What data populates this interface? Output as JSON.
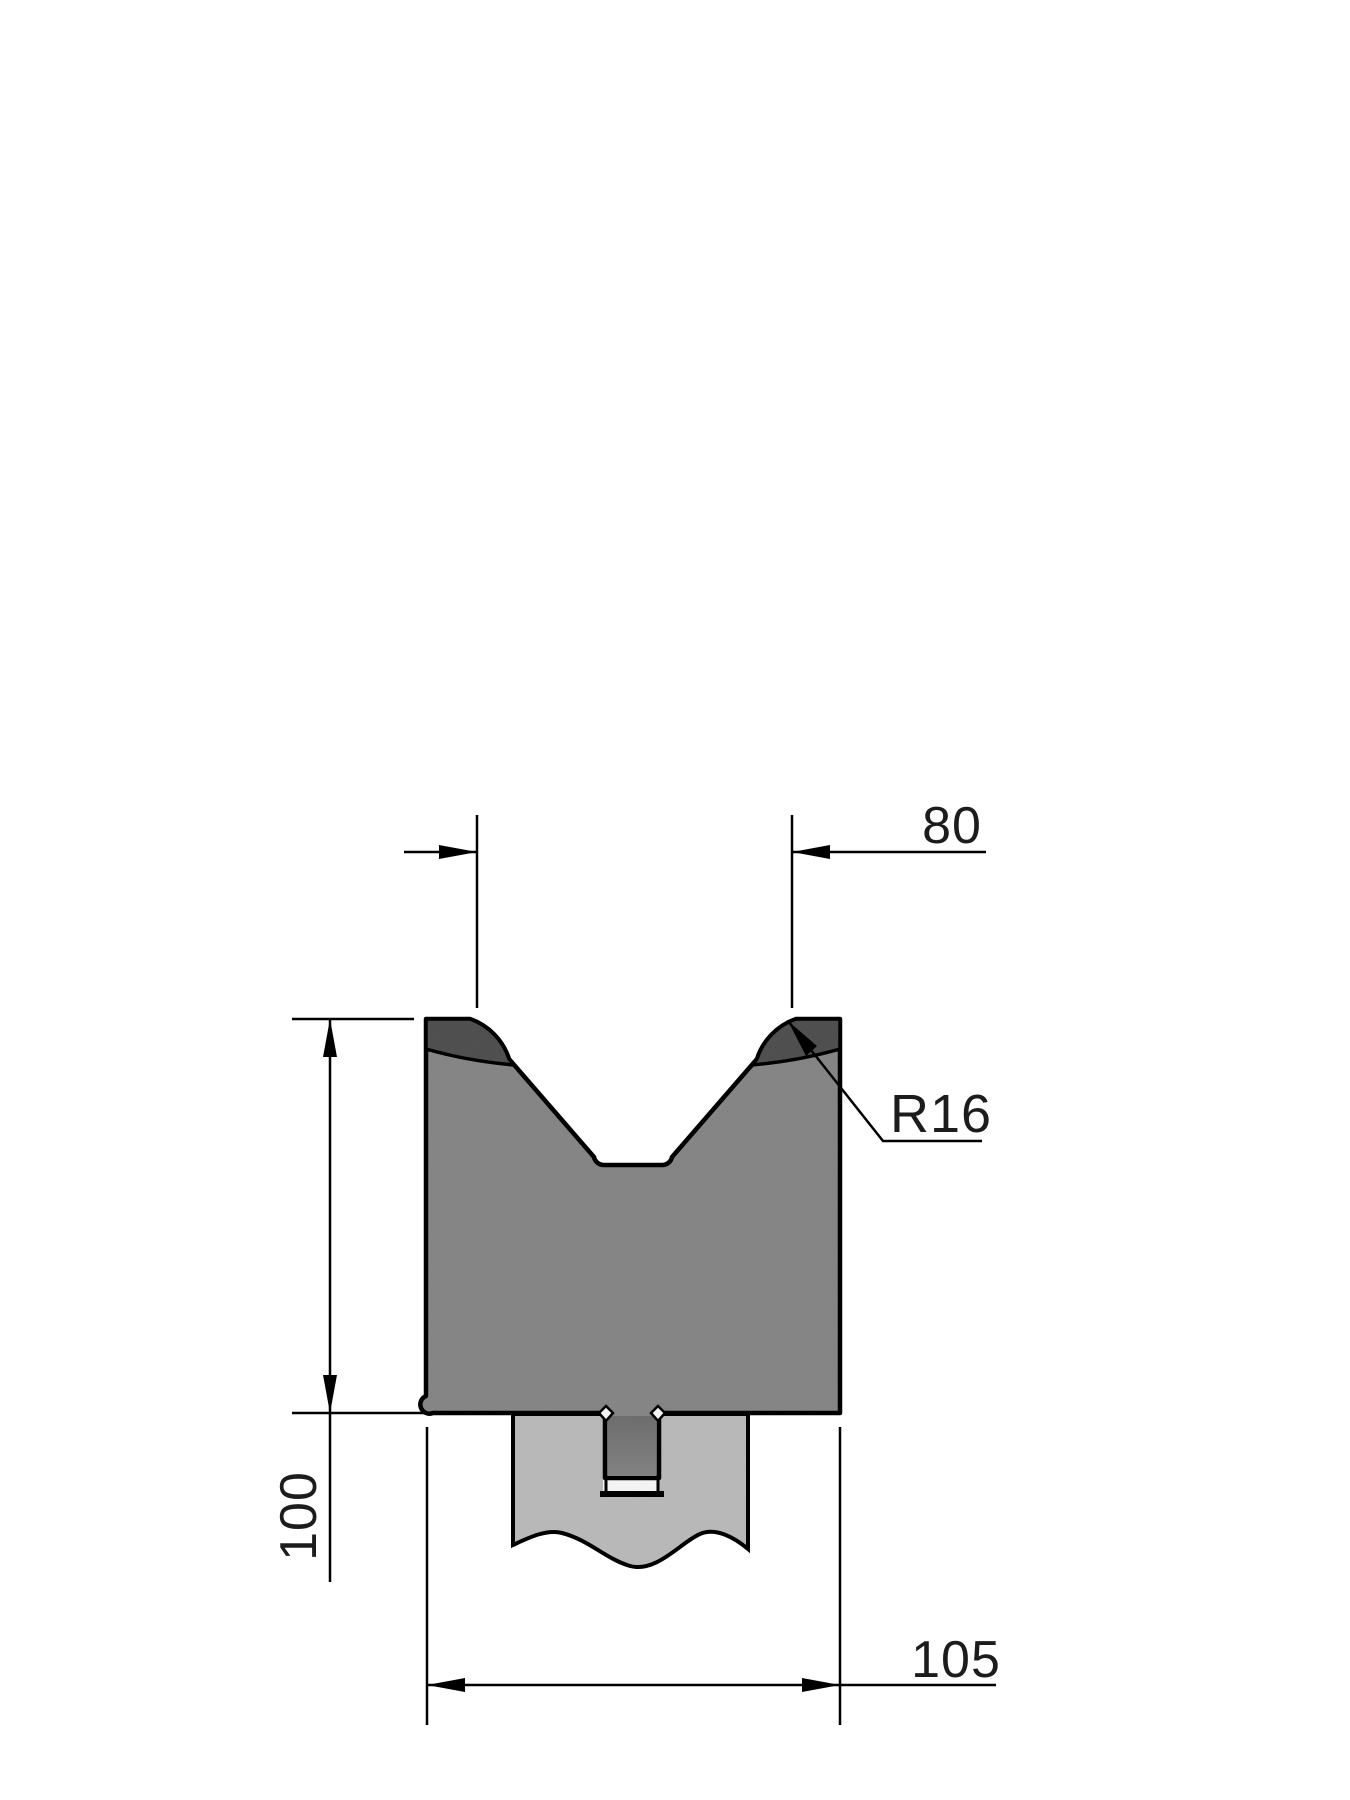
{
  "drawing": {
    "labels": {
      "v_opening_width": "80",
      "shoulder_radius": "R16",
      "die_height": "100",
      "die_width": "105"
    },
    "colors": {
      "background": "#ffffff",
      "line": "#000000",
      "die_body": "#8c8c8c",
      "hardened_zone": "#545454",
      "tenon_shadow_top": "#737373",
      "tenon_shadow_bottom": "#888888",
      "holder_shank": "#c1c1c1"
    }
  }
}
